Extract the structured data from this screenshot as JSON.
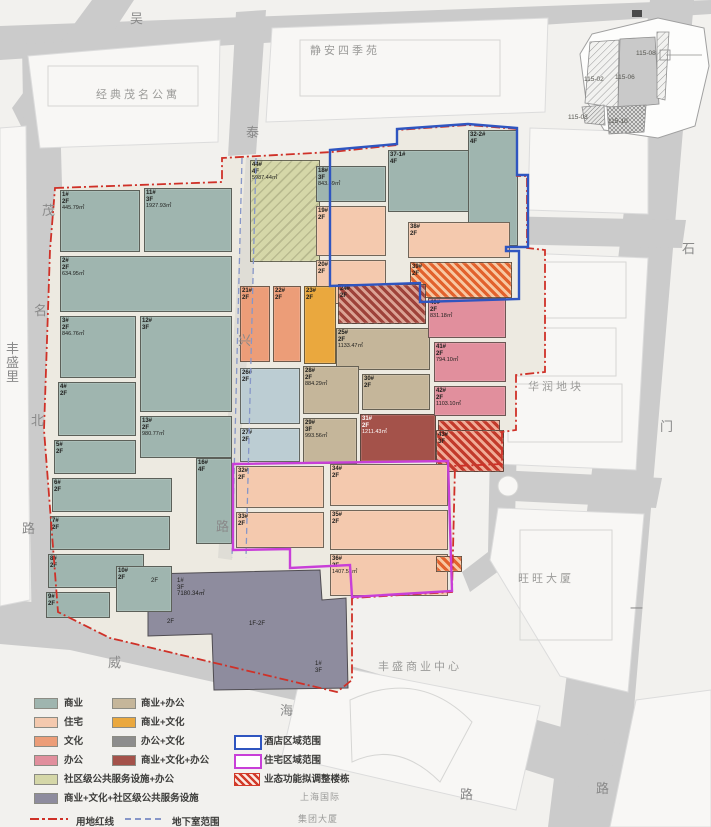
{
  "map_title": "地块业态规划总平面图",
  "streets": [
    {
      "text": "吴",
      "x": 130,
      "y": 8
    },
    {
      "text": "泰",
      "x": 246,
      "y": 122
    },
    {
      "text": "兴",
      "x": 238,
      "y": 330
    },
    {
      "text": "路",
      "x": 216,
      "y": 516
    },
    {
      "text": "茂",
      "x": 42,
      "y": 200
    },
    {
      "text": "名",
      "x": 34,
      "y": 300
    },
    {
      "text": "北",
      "x": 31,
      "y": 410
    },
    {
      "text": "路",
      "x": 22,
      "y": 518
    },
    {
      "text": "石",
      "x": 682,
      "y": 238
    },
    {
      "text": "门",
      "x": 660,
      "y": 416
    },
    {
      "text": "一",
      "x": 630,
      "y": 598
    },
    {
      "text": "路",
      "x": 596,
      "y": 778
    },
    {
      "text": "威",
      "x": 108,
      "y": 652
    },
    {
      "text": "海",
      "x": 280,
      "y": 700
    },
    {
      "text": "路",
      "x": 460,
      "y": 784
    },
    {
      "text": "丰",
      "x": 6,
      "y": 338
    },
    {
      "text": "盛",
      "x": 6,
      "y": 352
    },
    {
      "text": "里",
      "x": 6,
      "y": 366
    }
  ],
  "landmarks": [
    {
      "text": "经典茂名公寓",
      "x": 96,
      "y": 86,
      "small": false
    },
    {
      "text": "静安四季苑",
      "x": 310,
      "y": 42,
      "small": false
    },
    {
      "text": "华润地块",
      "x": 528,
      "y": 378,
      "small": false
    },
    {
      "text": "旺旺大厦",
      "x": 518,
      "y": 570,
      "small": false
    },
    {
      "text": "丰盛商业中心",
      "x": 378,
      "y": 658,
      "small": false
    },
    {
      "text": "上海国际",
      "x": 300,
      "y": 790,
      "small": true
    },
    {
      "text": "集团大厦",
      "x": 298,
      "y": 812,
      "small": true
    }
  ],
  "buildings": [
    {
      "id": "1#",
      "fl": "2F",
      "area": "445.79㎡",
      "cat": "shangye",
      "x": 60,
      "y": 190,
      "w": 80,
      "h": 62
    },
    {
      "id": "11#",
      "fl": "3F",
      "area": "1927.93㎡",
      "cat": "shangye",
      "x": 144,
      "y": 188,
      "w": 88,
      "h": 64
    },
    {
      "id": "2#",
      "fl": "2F",
      "area": "634.95㎡",
      "cat": "shangye",
      "x": 60,
      "y": 256,
      "w": 172,
      "h": 56
    },
    {
      "id": "3#",
      "fl": "2F",
      "area": "846.76㎡",
      "cat": "shangye",
      "x": 60,
      "y": 316,
      "w": 76,
      "h": 62
    },
    {
      "id": "12#",
      "fl": "3F",
      "area": "",
      "cat": "shangye",
      "x": 140,
      "y": 316,
      "w": 92,
      "h": 96
    },
    {
      "id": "4#",
      "fl": "2F",
      "area": "",
      "cat": "shangye",
      "x": 58,
      "y": 382,
      "w": 78,
      "h": 54
    },
    {
      "id": "13#",
      "fl": "2F",
      "area": "980.77㎡",
      "cat": "shangye",
      "x": 140,
      "y": 416,
      "w": 92,
      "h": 42
    },
    {
      "id": "5#",
      "fl": "2F",
      "area": "",
      "cat": "shangye",
      "x": 54,
      "y": 440,
      "w": 82,
      "h": 34
    },
    {
      "id": "6#",
      "fl": "2F",
      "area": "",
      "cat": "shangye",
      "x": 52,
      "y": 478,
      "w": 120,
      "h": 34
    },
    {
      "id": "7#",
      "fl": "2F",
      "area": "",
      "cat": "shangye",
      "x": 50,
      "y": 516,
      "w": 120,
      "h": 34
    },
    {
      "id": "8#",
      "fl": "2F",
      "area": "",
      "cat": "shangye",
      "x": 48,
      "y": 554,
      "w": 96,
      "h": 34
    },
    {
      "id": "9#",
      "fl": "2F",
      "area": "",
      "cat": "shangye",
      "x": 46,
      "y": 592,
      "w": 64,
      "h": 26
    },
    {
      "id": "10#",
      "fl": "2F",
      "area": "",
      "cat": "shangye",
      "x": 116,
      "y": 566,
      "w": 56,
      "h": 46
    },
    {
      "id": "16#",
      "fl": "4F",
      "area": "",
      "cat": "shangye",
      "x": 196,
      "y": 458,
      "w": 36,
      "h": 86
    },
    {
      "id": "44#",
      "fl": "4F",
      "area": "5987.44㎡",
      "cat": "sheban",
      "x": 250,
      "y": 160,
      "w": 70,
      "h": 102
    },
    {
      "id": "18#",
      "fl": "3F",
      "area": "843.49㎡",
      "cat": "shangye",
      "x": 316,
      "y": 166,
      "w": 70,
      "h": 36
    },
    {
      "id": "37-1#",
      "fl": "4F",
      "area": "",
      "cat": "shangye",
      "x": 388,
      "y": 150,
      "w": 86,
      "h": 62
    },
    {
      "id": "32-2#",
      "fl": "4F",
      "area": "",
      "cat": "shangye",
      "x": 468,
      "y": 130,
      "w": 50,
      "h": 116
    },
    {
      "id": "19#",
      "fl": "2F",
      "area": "",
      "cat": "zhuzhai",
      "x": 316,
      "y": 206,
      "w": 70,
      "h": 50
    },
    {
      "id": "20#",
      "fl": "2F",
      "area": "",
      "cat": "zhuzhai",
      "x": 316,
      "y": 260,
      "w": 70,
      "h": 44
    },
    {
      "id": "38#",
      "fl": "2F",
      "area": "",
      "cat": "zhuzhai",
      "x": 408,
      "y": 222,
      "w": 102,
      "h": 36
    },
    {
      "id": "39#",
      "fl": "2F",
      "area": "",
      "cat": "hatch-orange",
      "x": 410,
      "y": 262,
      "w": 102,
      "h": 36
    },
    {
      "id": "21#",
      "fl": "2F",
      "area": "",
      "cat": "wenhua",
      "x": 240,
      "y": 286,
      "w": 30,
      "h": 76
    },
    {
      "id": "22#",
      "fl": "2F",
      "area": "",
      "cat": "wenhua",
      "x": 273,
      "y": 286,
      "w": 28,
      "h": 76
    },
    {
      "id": "23#",
      "fl": "2F",
      "area": "",
      "cat": "shangwen",
      "x": 304,
      "y": 286,
      "w": 32,
      "h": 78
    },
    {
      "id": "24#",
      "fl": "2F",
      "area": "",
      "cat": "hatch-darkred",
      "x": 338,
      "y": 284,
      "w": 88,
      "h": 40
    },
    {
      "id": "25#",
      "fl": "2F",
      "area": "1133.47㎡",
      "cat": "shangban",
      "x": 336,
      "y": 328,
      "w": 94,
      "h": 42
    },
    {
      "id": "26#",
      "fl": "2F",
      "area": "",
      "cat": "ltblue",
      "x": 240,
      "y": 368,
      "w": 60,
      "h": 56
    },
    {
      "id": "27#",
      "fl": "2F",
      "area": "",
      "cat": "ltblue",
      "x": 240,
      "y": 428,
      "w": 60,
      "h": 34
    },
    {
      "id": "28#",
      "fl": "2F",
      "area": "884.29㎡",
      "cat": "shangban",
      "x": 303,
      "y": 366,
      "w": 56,
      "h": 48
    },
    {
      "id": "29#",
      "fl": "3F",
      "area": "993.56㎡",
      "cat": "shangban",
      "x": 303,
      "y": 418,
      "w": 54,
      "h": 46
    },
    {
      "id": "30#",
      "fl": "2F",
      "area": "",
      "cat": "shangban",
      "x": 362,
      "y": 374,
      "w": 68,
      "h": 36
    },
    {
      "id": "31#",
      "fl": "2F",
      "area": "1211.43㎡",
      "cat": "shangwenban",
      "x": 360,
      "y": 414,
      "w": 76,
      "h": 48
    },
    {
      "id": "",
      "fl": "",
      "area": "",
      "cat": "hatch-red",
      "x": 438,
      "y": 420,
      "w": 62,
      "h": 44
    },
    {
      "id": "40#",
      "fl": "2F",
      "area": "831.18㎡",
      "cat": "bangong",
      "x": 428,
      "y": 298,
      "w": 78,
      "h": 40
    },
    {
      "id": "41#",
      "fl": "2F",
      "area": "794.10㎡",
      "cat": "bangong",
      "x": 434,
      "y": 342,
      "w": 72,
      "h": 40
    },
    {
      "id": "42#",
      "fl": "2F",
      "area": "1103.10㎡",
      "cat": "bangong",
      "x": 434,
      "y": 386,
      "w": 72,
      "h": 30
    },
    {
      "id": "43#",
      "fl": "3F",
      "area": "",
      "cat": "hatch-red",
      "x": 436,
      "y": 430,
      "w": 68,
      "h": 42
    },
    {
      "id": "32#",
      "fl": "2F",
      "area": "",
      "cat": "zhuzhai",
      "x": 236,
      "y": 466,
      "w": 88,
      "h": 42
    },
    {
      "id": "33#",
      "fl": "2F",
      "area": "",
      "cat": "zhuzhai",
      "x": 236,
      "y": 512,
      "w": 88,
      "h": 36
    },
    {
      "id": "34#",
      "fl": "2F",
      "area": "",
      "cat": "zhuzhai",
      "x": 330,
      "y": 464,
      "w": 118,
      "h": 42
    },
    {
      "id": "35#",
      "fl": "2F",
      "area": "",
      "cat": "zhuzhai",
      "x": 330,
      "y": 510,
      "w": 118,
      "h": 40
    },
    {
      "id": "36#",
      "fl": "2F",
      "area": "1407.51㎡",
      "cat": "zhuzhai",
      "x": 330,
      "y": 554,
      "w": 118,
      "h": 42
    },
    {
      "id": "",
      "fl": "",
      "area": "",
      "cat": "hatch-orange",
      "x": 436,
      "y": 556,
      "w": 26,
      "h": 16
    }
  ],
  "annotations": [
    {
      "text": "2F",
      "x": 150,
      "y": 577
    },
    {
      "text": "1#\n3F\n7180.34㎡",
      "x": 176,
      "y": 577
    },
    {
      "text": "2F",
      "x": 166,
      "y": 618
    },
    {
      "text": "1F-2F",
      "x": 248,
      "y": 620
    },
    {
      "text": "1#\n3F",
      "x": 314,
      "y": 660
    }
  ],
  "legend": {
    "col1": [
      {
        "label": "商业",
        "color": "#9fb5af"
      },
      {
        "label": "住宅",
        "color": "#f4c9ae"
      },
      {
        "label": "文化",
        "color": "#ec9d78"
      },
      {
        "label": "办公",
        "color": "#e18f9d"
      }
    ],
    "col2": [
      {
        "label": "商业+办公",
        "color": "#c5b69a"
      },
      {
        "label": "商业+文化",
        "color": "#eaa83e"
      },
      {
        "label": "办公+文化",
        "color": "#8d8d8d"
      },
      {
        "label": "商业+文化+办公",
        "color": "#a4524a"
      }
    ],
    "wide": [
      {
        "label": "社区级公共服务设施+办公",
        "color": "#d5d7a8"
      },
      {
        "label": "商业+文化+社区级公共服务设施",
        "color": "#8e8c9e"
      }
    ],
    "zones": [
      {
        "label": "酒店区域范围",
        "color": "#2f55c0",
        "type": "outline"
      },
      {
        "label": "住宅区域范围",
        "color": "#c83fd8",
        "type": "outline"
      },
      {
        "label": "业态功能拟调整楼栋",
        "color": "#d23b2a",
        "type": "hatch"
      }
    ],
    "lines": [
      {
        "label": "用地红线",
        "style": "dashdot",
        "color": "#cf3128"
      },
      {
        "label": "地下室范围",
        "style": "dashed",
        "color": "#8696c8"
      }
    ]
  },
  "inset": {
    "parcels": [
      {
        "label": "115-02",
        "x": 22,
        "y": 68
      },
      {
        "label": "115-06",
        "x": 53,
        "y": 66
      },
      {
        "label": "115-08",
        "x": 74,
        "y": 42
      },
      {
        "label": "115-03",
        "x": 6,
        "y": 106
      },
      {
        "label": "115-10",
        "x": 46,
        "y": 110
      }
    ]
  },
  "colors": {
    "boundary_red": "#cf3128",
    "hotel_zone_blue": "#2f55c0",
    "residential_zone_magenta": "#c83fd8",
    "basement_dash_blue": "#8696c8",
    "road_gray": "#cbcbcb",
    "site_beige": "#edeae1"
  }
}
